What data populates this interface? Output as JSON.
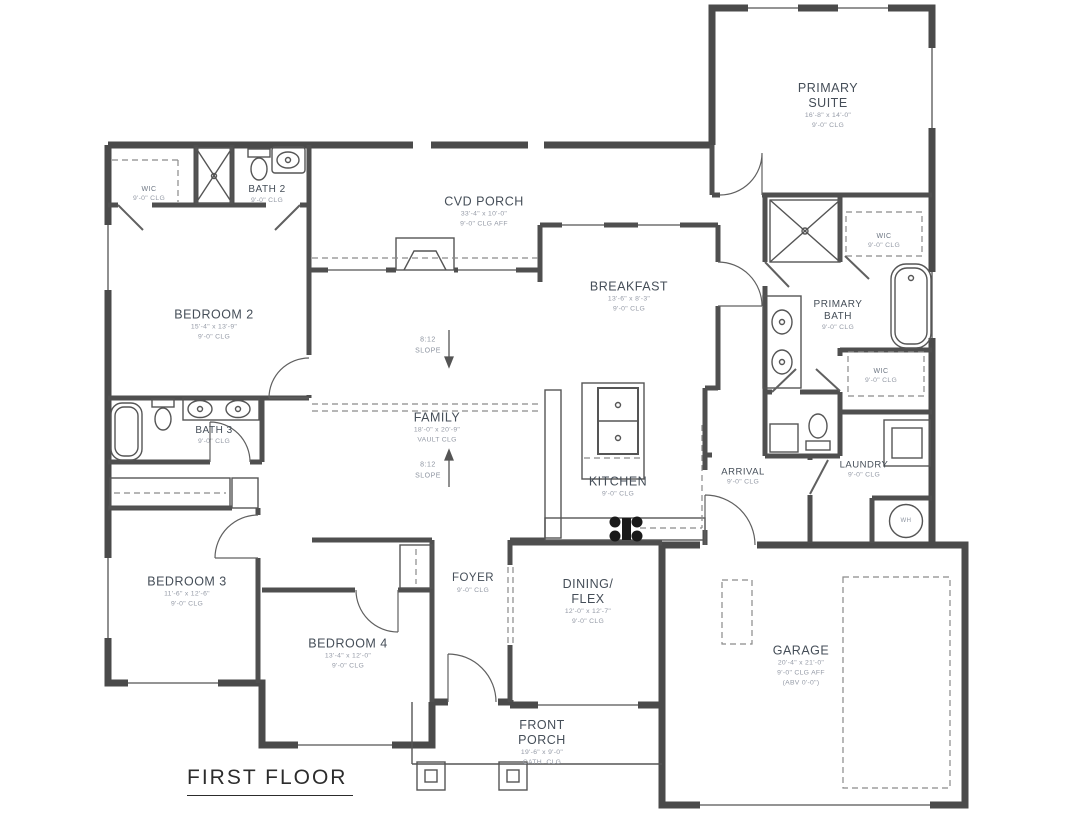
{
  "title": {
    "text": "FIRST FLOOR"
  },
  "rooms": {
    "primary_suite": {
      "name": "PRIMARY SUITE",
      "dims": "16'-8\" x 14'-0\"",
      "clg": "9'-0\" CLG"
    },
    "cvd_porch": {
      "name": "CVD PORCH",
      "dims": "33'-4\" x 10'-0\"",
      "clg": "9'-0\" CLG AFF"
    },
    "breakfast": {
      "name": "BREAKFAST",
      "dims": "13'-6\" x 8'-3\"",
      "clg": "9'-0\" CLG"
    },
    "wic_bedroom2": {
      "name": "WIC",
      "clg": "9'-0\" CLG"
    },
    "bath2": {
      "name": "BATH 2",
      "clg": "9'-0\" CLG"
    },
    "bedroom2": {
      "name": "BEDROOM 2",
      "dims": "15'-4\" x 13'-9\"",
      "clg": "9'-0\" CLG"
    },
    "family": {
      "name": "FAMILY",
      "dims": "18'-0\" x 20'-9\"",
      "clg": "VAULT CLG"
    },
    "kitchen": {
      "name": "KITCHEN",
      "clg": "9'-0\" CLG"
    },
    "primary_bath": {
      "name": "PRIMARY BATH",
      "clg": "9'-0\" CLG"
    },
    "wic_primary_1": {
      "name": "WIC",
      "clg": "9'-0\" CLG"
    },
    "wic_primary_2": {
      "name": "WIC",
      "clg": "9'-0\" CLG"
    },
    "arrival": {
      "name": "ARRIVAL",
      "clg": "9'-0\" CLG"
    },
    "laundry": {
      "name": "LAUNDRY",
      "clg": "9'-0\" CLG"
    },
    "bath3": {
      "name": "BATH 3",
      "clg": "9'-0\" CLG"
    },
    "bedroom3": {
      "name": "BEDROOM 3",
      "dims": "11'-6\" x 12'-6\"",
      "clg": "9'-0\" CLG"
    },
    "bedroom4": {
      "name": "BEDROOM 4",
      "dims": "13'-4\" x 12'-0\"",
      "clg": "9'-0\" CLG"
    },
    "foyer": {
      "name": "FOYER",
      "clg": "9'-0\" CLG"
    },
    "dining": {
      "name": "DINING/ FLEX",
      "dims": "12'-0\" x 12'-7\"",
      "clg": "9'-0\" CLG"
    },
    "garage": {
      "name": "GARAGE",
      "dims": "20'-4\" x 21'-0\"",
      "clg": "9'-0\" CLG AFF",
      "note": "(ABV 0'-0\")"
    },
    "front_porch": {
      "name": "FRONT PORCH",
      "dims": "19'-6\" x 9'-0\"",
      "clg": "CATH. CLG"
    }
  },
  "annotations": {
    "slope_upper": {
      "ratio": "8:12",
      "word": "SLOPE"
    },
    "slope_lower": {
      "ratio": "8:12",
      "word": "SLOPE"
    },
    "water_heater": "WH"
  },
  "colors": {
    "wall": "#4a4a4a",
    "line": "#555555",
    "dashed": "#8a8a8a",
    "label": "#454e58",
    "dim_text": "#949aa6",
    "background": "#ffffff"
  }
}
